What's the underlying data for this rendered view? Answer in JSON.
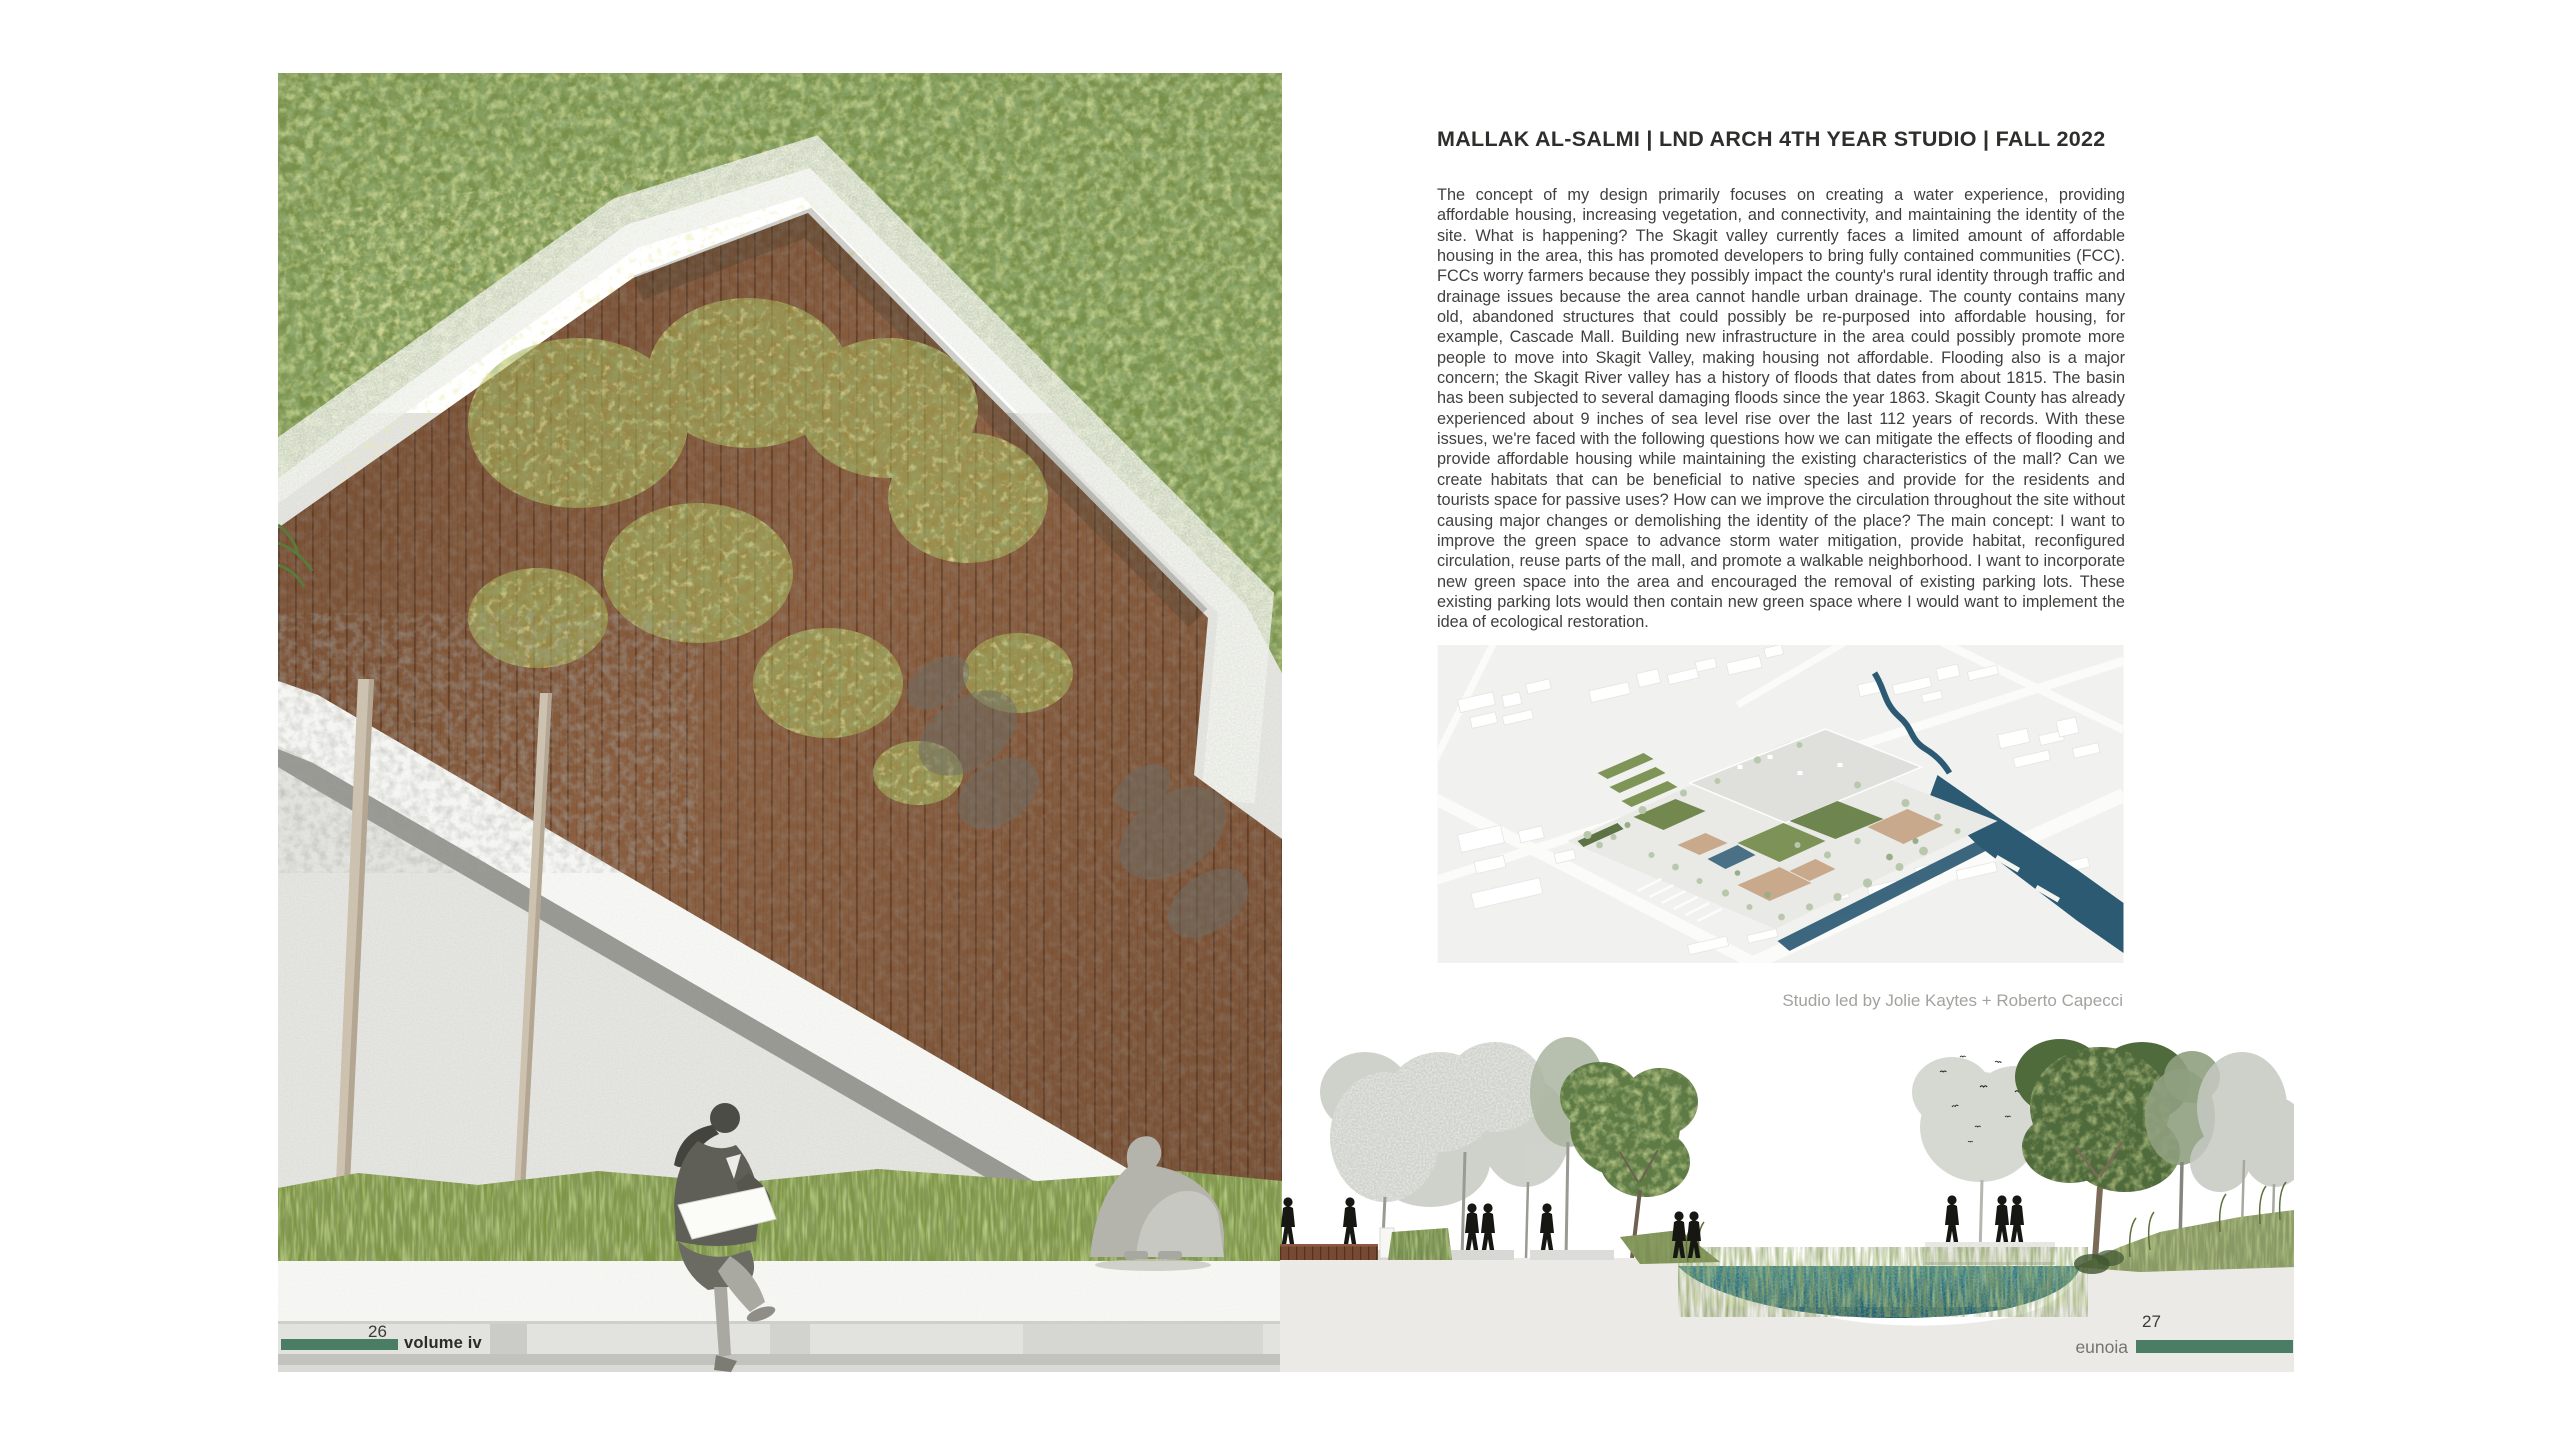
{
  "left_page": {
    "artwork_alt": "Perspective collage of an angular green-roofed pavilion with vertical wooden slat walls, a translucent concrete roof band, tree canopy above, a speckled concrete plaza with tree trunks and leaf shadows, a grass strip and a white ledge where a woman sits sketching and a man sits hugging his knees",
    "footer": {
      "page_number": "26",
      "volume_label": "volume iv",
      "bar_color": "#4b7d64"
    }
  },
  "right_page": {
    "header": "MALLAK AL-SALMI | LND ARCH 4TH YEAR STUDIO | FALL 2022",
    "body_text": "The concept of my design primarily focuses on creating a water experience, providing affordable housing, increasing vegetation, and connectivity, and maintaining the identity of the site. What is happening? The Skagit valley currently faces a limited amount of affordable housing in the area, this has promoted developers to bring fully contained communities (FCC). FCCs worry farmers because they possibly impact the county's rural identity through traffic and drainage issues because the area cannot handle urban drainage. The county contains many old, abandoned structures that could possibly be re-purposed into affordable housing, for example, Cascade Mall. Building new infrastructure in the area could possibly promote more people to move into Skagit Valley, making housing not affordable. Flooding also is a major concern; the Skagit River valley has a history of floods that dates from about 1815. The basin has been subjected to several damaging floods since the year 1863. Skagit County has already experienced about 9 inches of sea level rise over the last 112 years of records. With these issues, we're faced with the following questions how we can mitigate the effects of flooding and provide affordable housing while maintaining the existing characteristics of the mall? Can we create habitats that can be beneficial to native species and provide for the residents and tourists space for passive uses? How can we improve the circulation throughout the site without causing major changes or demolishing the identity of the place? The main concept: I want to improve the green space to advance storm water mitigation, provide habitat, reconfigured circulation, reuse parts of the mall, and promote a walkable neighborhood. I want to incorporate new green space into the area and encouraged the removal of existing parking lots. These existing parking lots would then contain new green space where I would want to implement the idea of ecological restoration.",
    "aerial_alt": "Aerial axonometric rendering of the Cascade Mall site with green roofs, tan courtyards, tree clusters, white surrounding buildings and a dark blue river and canal",
    "caption": "Studio led by Jolie Kaytes + Roberto Capecci",
    "section_alt": "Sectional elevation with a wooden boardwalk, black human silhouettes, faded and green trees, a flock of birds, grasses and a teal stormwater pond in a depression",
    "footer": {
      "page_number": "27",
      "imprint": "eunoia",
      "bar_color": "#4b7d64"
    }
  },
  "colors": {
    "accent_green_bar": "#4b7d64",
    "wood_brown": "#8a5e3f",
    "canopy_green": "#78904a",
    "water_blue": "#2d5a73",
    "pond_teal": "#2c7380",
    "plaza_gray": "#e4e4e0"
  }
}
